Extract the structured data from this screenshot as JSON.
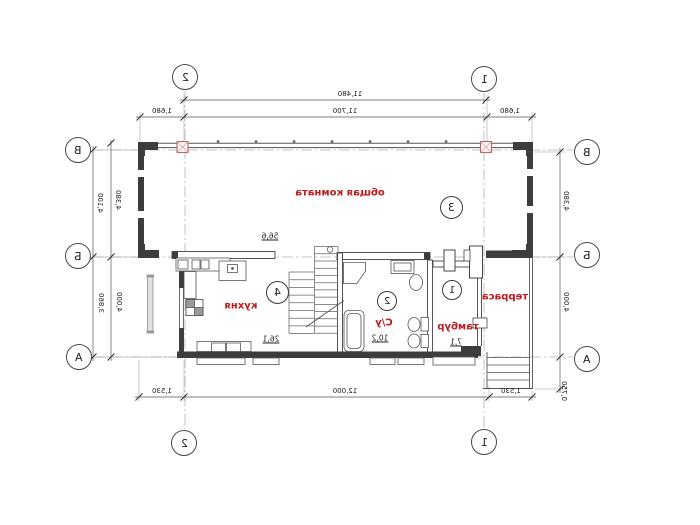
{
  "axes": {
    "top": {
      "left": "2",
      "right": "1"
    },
    "bottom": {
      "left": "2",
      "right": "1"
    },
    "left": {
      "top": "В",
      "middle": "Б",
      "bottom": "А"
    },
    "right": {
      "top": "В",
      "middle": "Б",
      "bottom": "А"
    }
  },
  "dimensions": {
    "top_overall": "11,480",
    "top_left": "1,680",
    "top_middle": "11,700",
    "top_right": "1,680",
    "bottom_left": "1,530",
    "bottom_middle": "12,000",
    "bottom_right": "1,530",
    "left_outer_upper": "4,100",
    "left_inner_upper": "4,380",
    "left_outer_lower": "3,860",
    "left_inner_lower": "4,000",
    "right_upper": "4,380",
    "right_lower": "4,000",
    "right_bottom": "0,750"
  },
  "rooms": {
    "living": {
      "number": "3",
      "name": "общая комната",
      "area": "56,6"
    },
    "kitchen": {
      "number": "4",
      "name": "кухня",
      "area": "26,1"
    },
    "bathroom": {
      "number": "2",
      "name": "С/у",
      "area": "10,2"
    },
    "vestibule": {
      "number": "1",
      "name": "тамбур",
      "area": "7,1"
    },
    "terrace": {
      "name": "терраса"
    }
  },
  "colors": {
    "room_label": "#c0181c",
    "wall": "#3d3d3d",
    "column_outline": "#b46a66"
  }
}
